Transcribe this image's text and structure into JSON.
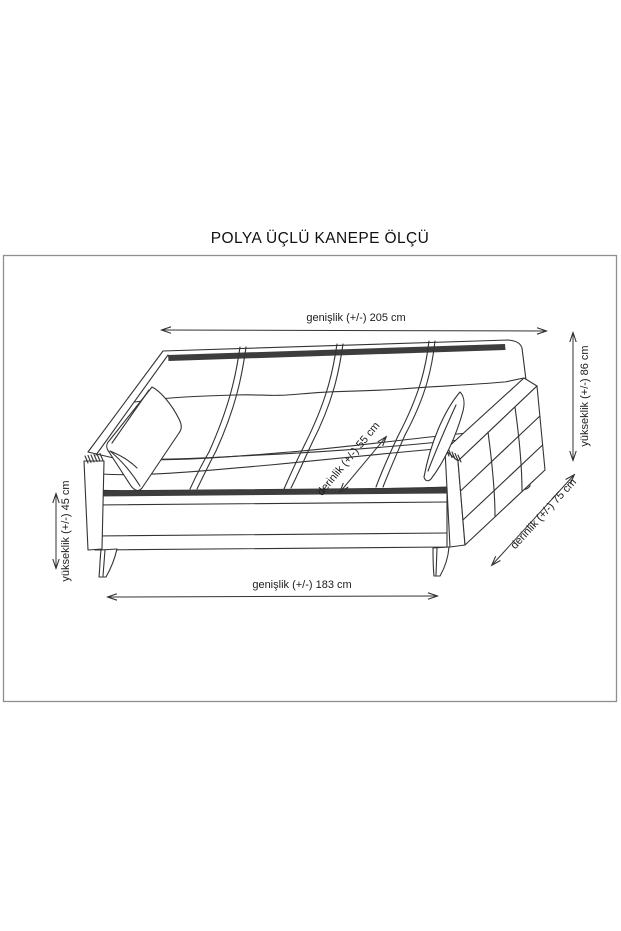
{
  "title": "POLYA ÜÇLÜ KANEPE ÖLÇÜ",
  "canvas": {
    "background": "#ffffff",
    "frame_border_color": "#8f8f8f",
    "line_color": "#333333",
    "accent_fill": "#3d3d3d",
    "text_color": "#1c1c1c"
  },
  "diagram": {
    "type": "furniture-dimension-drawing",
    "subject": "üçlü kanepe (three-seat sofa) line drawing with dimension arrows",
    "dimensions": [
      {
        "id": "top-width",
        "label": "genişlik (+/-) 205 cm",
        "measure": "genişlik",
        "tolerance": "+/-",
        "value": 205,
        "unit": "cm",
        "orientation": "horizontal"
      },
      {
        "id": "right-height",
        "label": "yükseklik (+/-) 86 cm",
        "measure": "yükseklik",
        "tolerance": "+/-",
        "value": 86,
        "unit": "cm",
        "orientation": "vertical"
      },
      {
        "id": "left-height",
        "label": "yükseklik (+/-) 45 cm",
        "measure": "yükseklik",
        "tolerance": "+/-",
        "value": 45,
        "unit": "cm",
        "orientation": "vertical"
      },
      {
        "id": "bottom-width",
        "label": "genişlik (+/-) 183 cm",
        "measure": "genişlik",
        "tolerance": "+/-",
        "value": 183,
        "unit": "cm",
        "orientation": "horizontal"
      },
      {
        "id": "seat-depth",
        "label": "derinlik (+/-) 55 cm",
        "measure": "derinlik",
        "tolerance": "+/-",
        "value": 55,
        "unit": "cm",
        "orientation": "diagonal"
      },
      {
        "id": "overall-depth",
        "label": "derinlik (+/-) 75 cm",
        "measure": "derinlik",
        "tolerance": "+/-",
        "value": 75,
        "unit": "cm",
        "orientation": "diagonal"
      }
    ]
  }
}
